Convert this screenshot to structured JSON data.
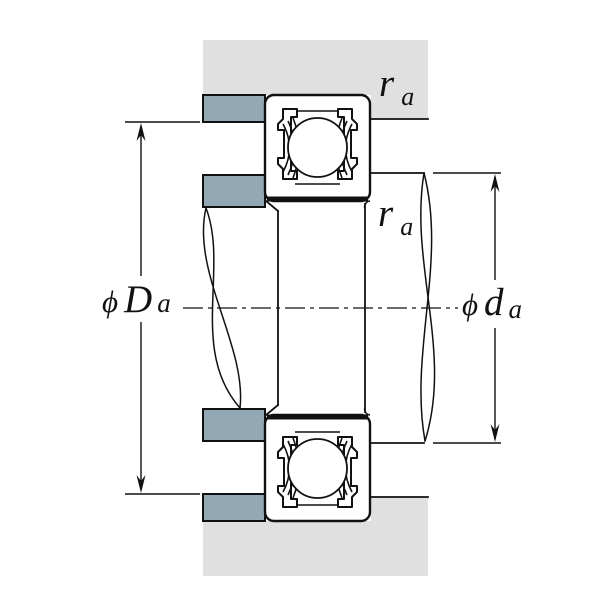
{
  "figure": {
    "description": "Shielded deep groove ball bearing mounting cross-section with shaft and housing abutment (shoulder) dimensions",
    "labels": {
      "fillet_housing": {
        "main": "r",
        "sub": "a"
      },
      "fillet_shaft": {
        "main": "r",
        "sub": "a"
      },
      "housing_shoulder_dia": {
        "phi": "ϕ",
        "main": "D",
        "sub": "a"
      },
      "shaft_shoulder_dia": {
        "phi": "ϕ",
        "main": "d",
        "sub": "a"
      }
    },
    "colors": {
      "housing": "#e0e0e0",
      "shoulder": "#92a8b2",
      "line": "#111111",
      "background": "#ffffff"
    }
  }
}
